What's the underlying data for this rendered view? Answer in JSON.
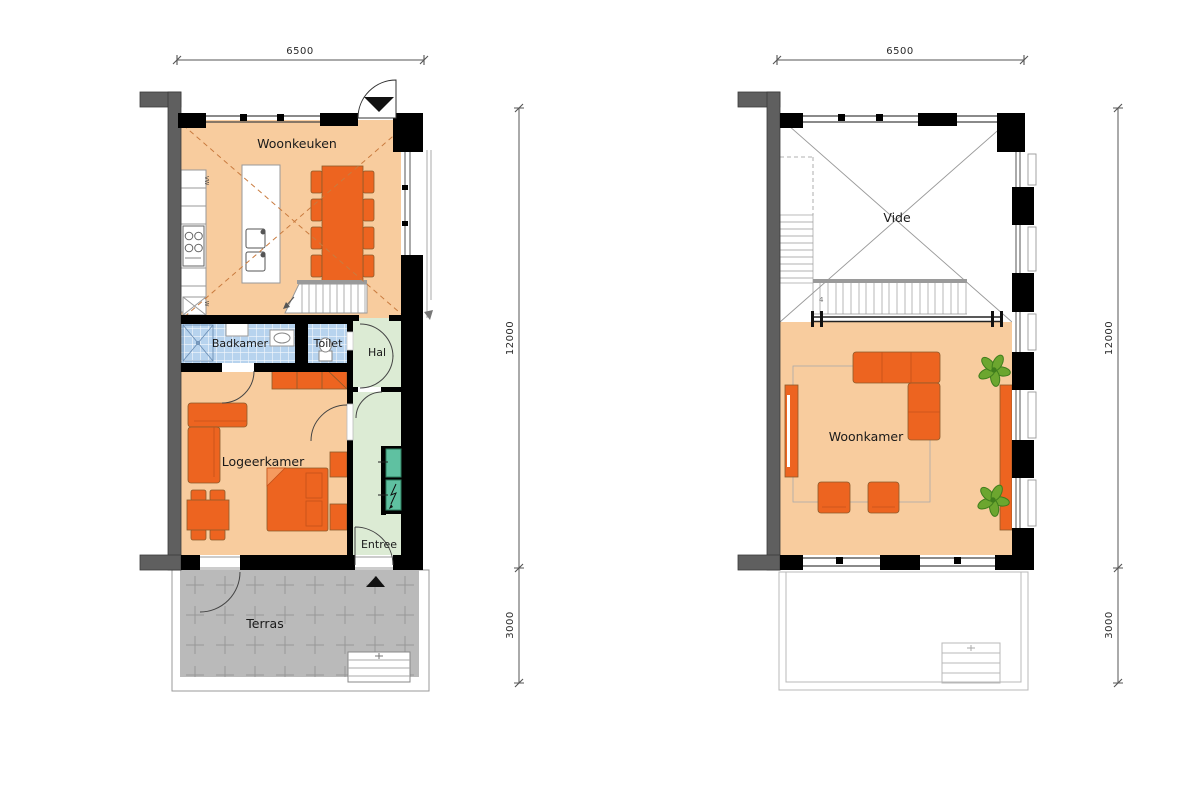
{
  "colors": {
    "floor": "#F8CC9E",
    "furniture": "#ED6420",
    "tile_blue": "#B7D3EE",
    "room_green": "#DCEBD4",
    "closet_teal": "#5FC1A1",
    "terrace_grey": "#BABABA",
    "wall_black": "#000000",
    "party_wall_grey": "#5F5F5F",
    "plant_green": "#6CA62F",
    "dash_orange": "#C97B3F"
  },
  "plans": {
    "ground": {
      "rooms": {
        "woonkeuken": "Woonkeuken",
        "badkamer": "Badkamer",
        "toilet": "Toilet",
        "hal": "Hal",
        "logeerkamer": "Logeerkamer",
        "entree": "Entree",
        "terras": "Terras"
      },
      "appliance_labels": {
        "dishwasher": "VW",
        "washer": "W"
      },
      "dims": {
        "width": "6500",
        "height_main": "12000",
        "height_terrace": "3000"
      }
    },
    "upper": {
      "rooms": {
        "vide": "Vide",
        "woonkamer": "Woonkamer"
      },
      "stair_label": "4",
      "dims": {
        "width": "6500",
        "height_main": "12000",
        "height_terrace": "3000"
      }
    }
  }
}
